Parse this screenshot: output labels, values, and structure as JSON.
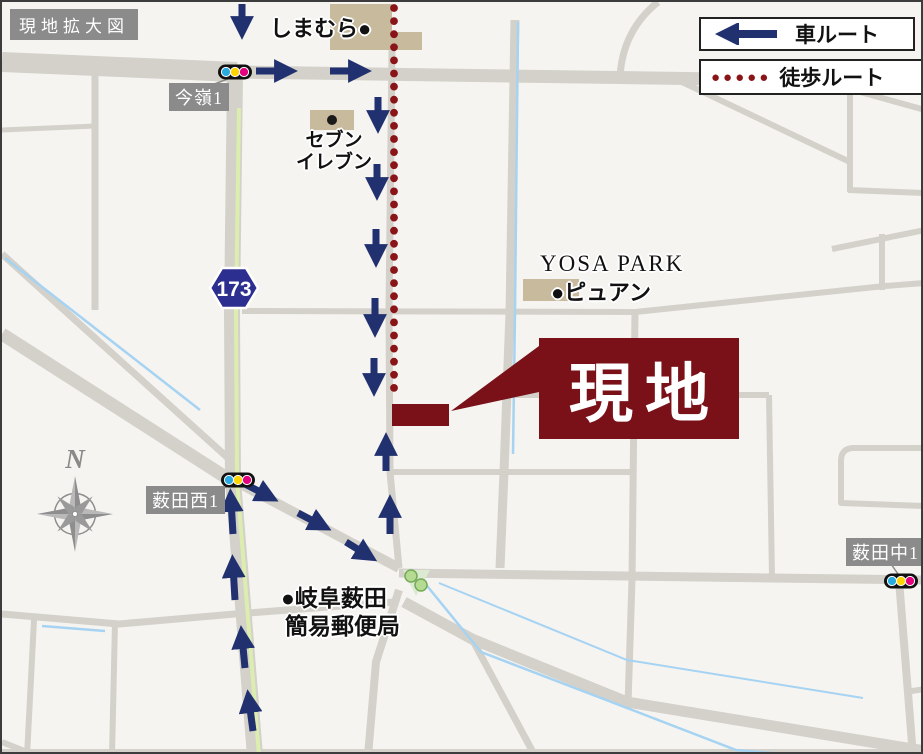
{
  "title": "現地拡大図",
  "legend": {
    "car": "車ルート",
    "walk": "徒歩ルート",
    "walk_dots_icon": "●●●●●"
  },
  "intersections": {
    "imamine": "今嶺1",
    "yabuta_nishi": "薮田西1",
    "yabuta_naka": "薮田中1"
  },
  "pois": {
    "shimamura": "しまむら●",
    "seven_line1": "セブン",
    "seven_line2": "イレブン",
    "yosa_park": "YOSA PARK",
    "pyuan": "●ピュアン",
    "post_office_line1": "●岐阜薮田",
    "post_office_line2": "簡易郵便局",
    "site": "現地",
    "route_shield": "173",
    "compass_n": "N"
  },
  "colors": {
    "car_route": "#21306e",
    "walk_route": "#8a1518",
    "site_box": "#7a1118",
    "road": "#d3d1c9",
    "building": "#c8ba9d",
    "water": "#a6d3f2",
    "route_stripe": "#dcedb0",
    "label_bg": "#8b8b8b"
  }
}
